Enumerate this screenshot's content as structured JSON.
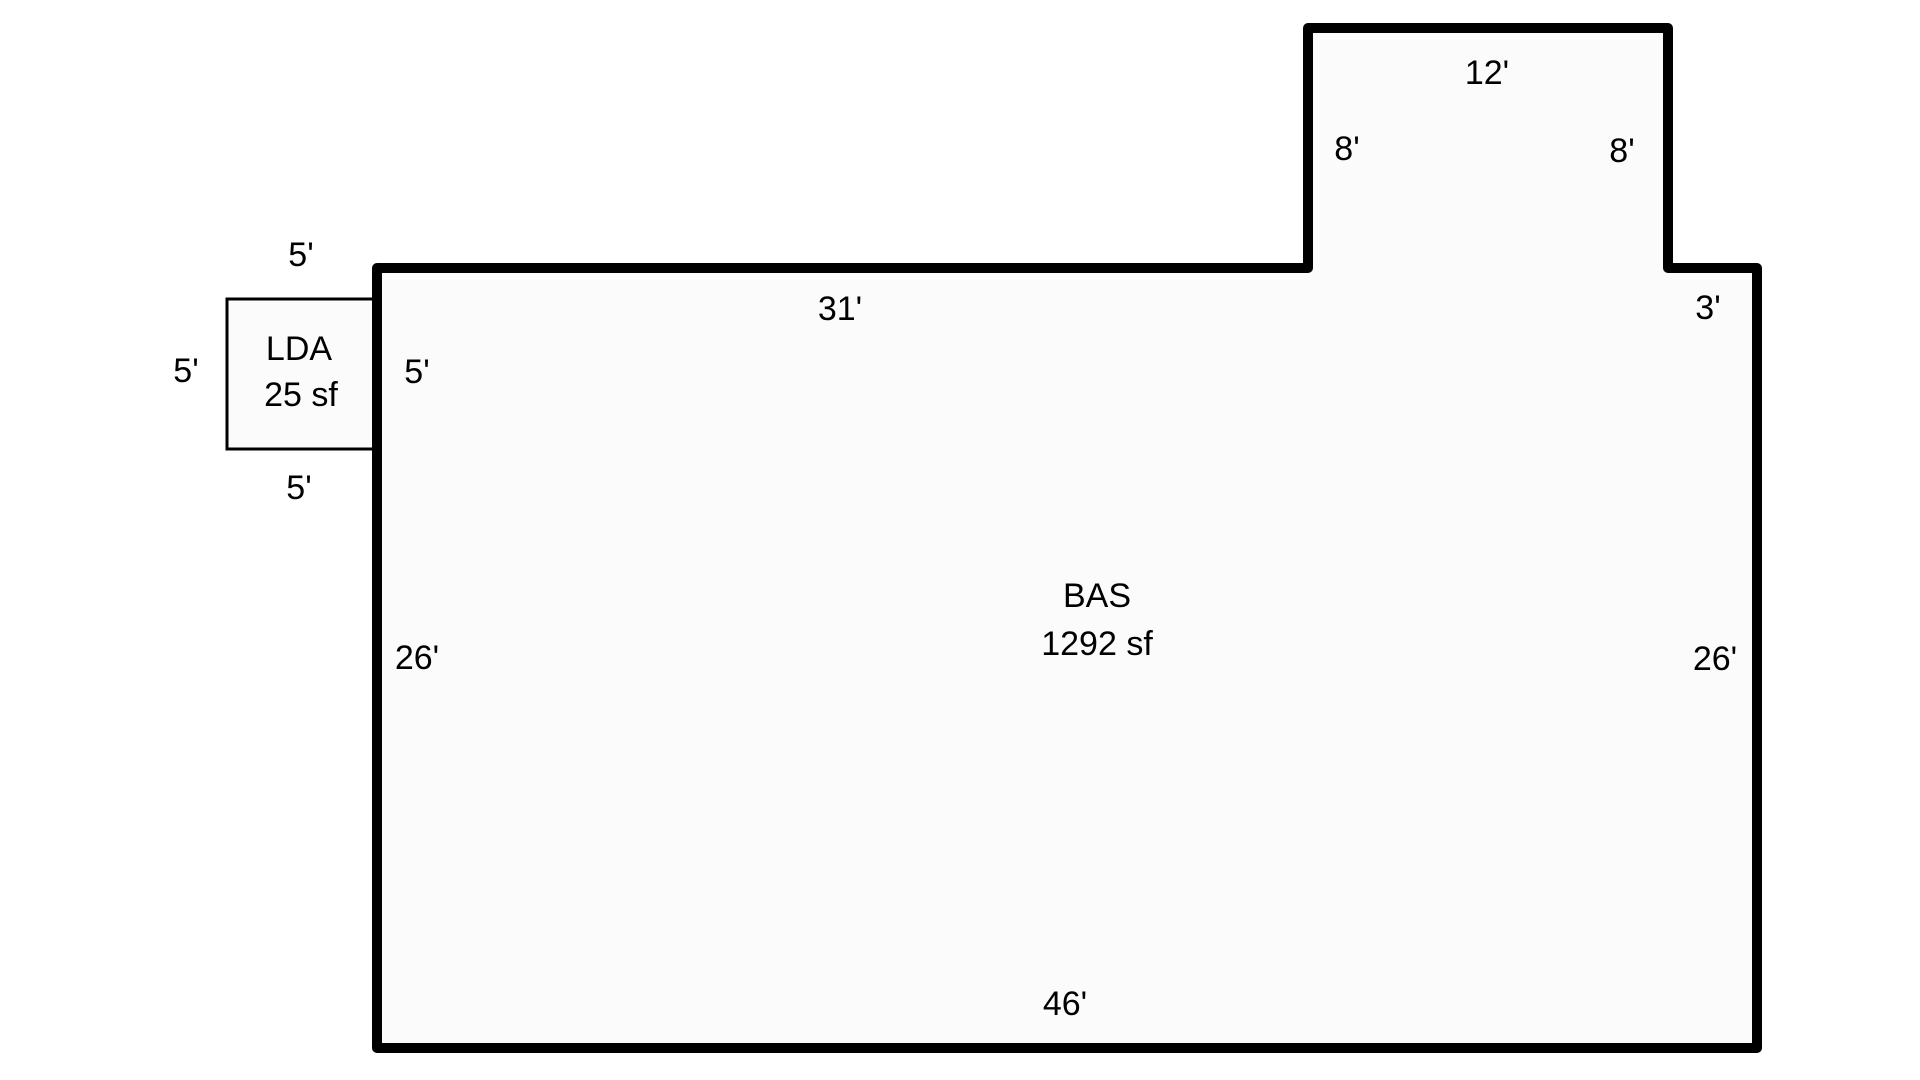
{
  "diagram": {
    "type": "floor-plan-area-sketch",
    "colors": {
      "background": "#ffffff",
      "outline": "#000000",
      "interior_fill": "#fbfbfb",
      "text": "#000000"
    },
    "scale_px_per_foot": 30,
    "main_area": {
      "code": "BAS",
      "size": "1292 sf"
    },
    "attached_area": {
      "code": "LDA",
      "size": "25 sf"
    },
    "dimensions": {
      "bump_top": "12'",
      "bump_left_side": "8'",
      "bump_right_side": "8'",
      "top_wall": "31'",
      "right_step": "3'",
      "left_wall": "26'",
      "right_wall": "26'",
      "bottom_wall": "46'",
      "lda_top": "5'",
      "lda_left": "5'",
      "lda_right_inner": "5'",
      "lda_bottom": "5'"
    }
  }
}
